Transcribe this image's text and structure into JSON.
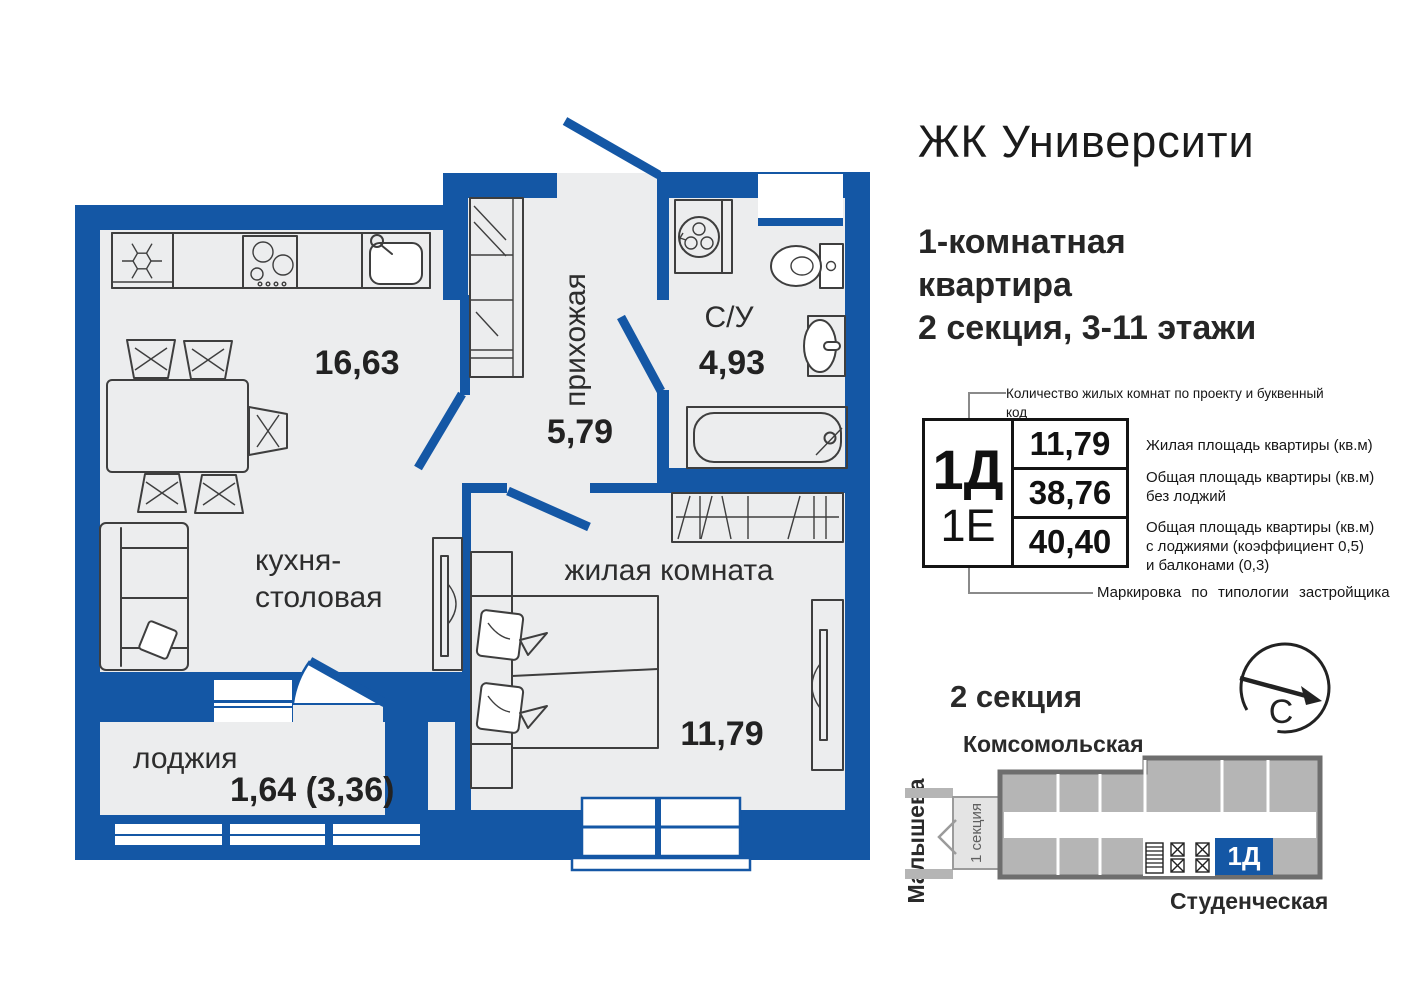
{
  "brand": "ЖК Университи",
  "subtitle": "1-комнатная\nквартира\n2 секция, 3-11 этажи",
  "plan": {
    "rooms": {
      "kitchen": {
        "name_line1": "кухня-",
        "name_line2": "столовая",
        "area": "16,63"
      },
      "hallway": {
        "name": "прихожая",
        "area": "5,79"
      },
      "bathroom": {
        "name": "С/У",
        "area": "4,93"
      },
      "living": {
        "name": "жилая комната",
        "area": "11,79"
      },
      "loggia": {
        "name": "лоджия",
        "area": "1,64 (3,36)"
      }
    }
  },
  "spec": {
    "room_code": "1Д",
    "type_code": "1Е",
    "living_area": "11,79",
    "total_area": "38,76",
    "total_area_with_loggia": "40,40",
    "annotations": {
      "top": "Количество жилых комнат по проекту и буквенный код",
      "living_area": "Жилая площадь квартиры (кв.м)",
      "total_area": "Общая площадь квартиры (кв.м)\nбез лоджий",
      "total_with_loggia": "Общая площадь квартиры (кв.м)\nс лоджиями (коэффициент 0,5)\nи балконами (0,3)",
      "bottom": "Маркировка по типологии застройщика"
    }
  },
  "section_map": {
    "title": "2 секция",
    "street_top": "Комсомольская",
    "street_left": "Малышева",
    "street_bottom": "Студенческая",
    "adjacent_section": "1 секция",
    "unit_label": "1Д",
    "north_label": "С"
  },
  "colors": {
    "wall_blue": "#1457A5",
    "floor_gray": "#ECEDEE",
    "map_building_gray": "#B5B5B5",
    "map_outline_gray": "#6E6E6E",
    "text_dark": "#222222"
  }
}
